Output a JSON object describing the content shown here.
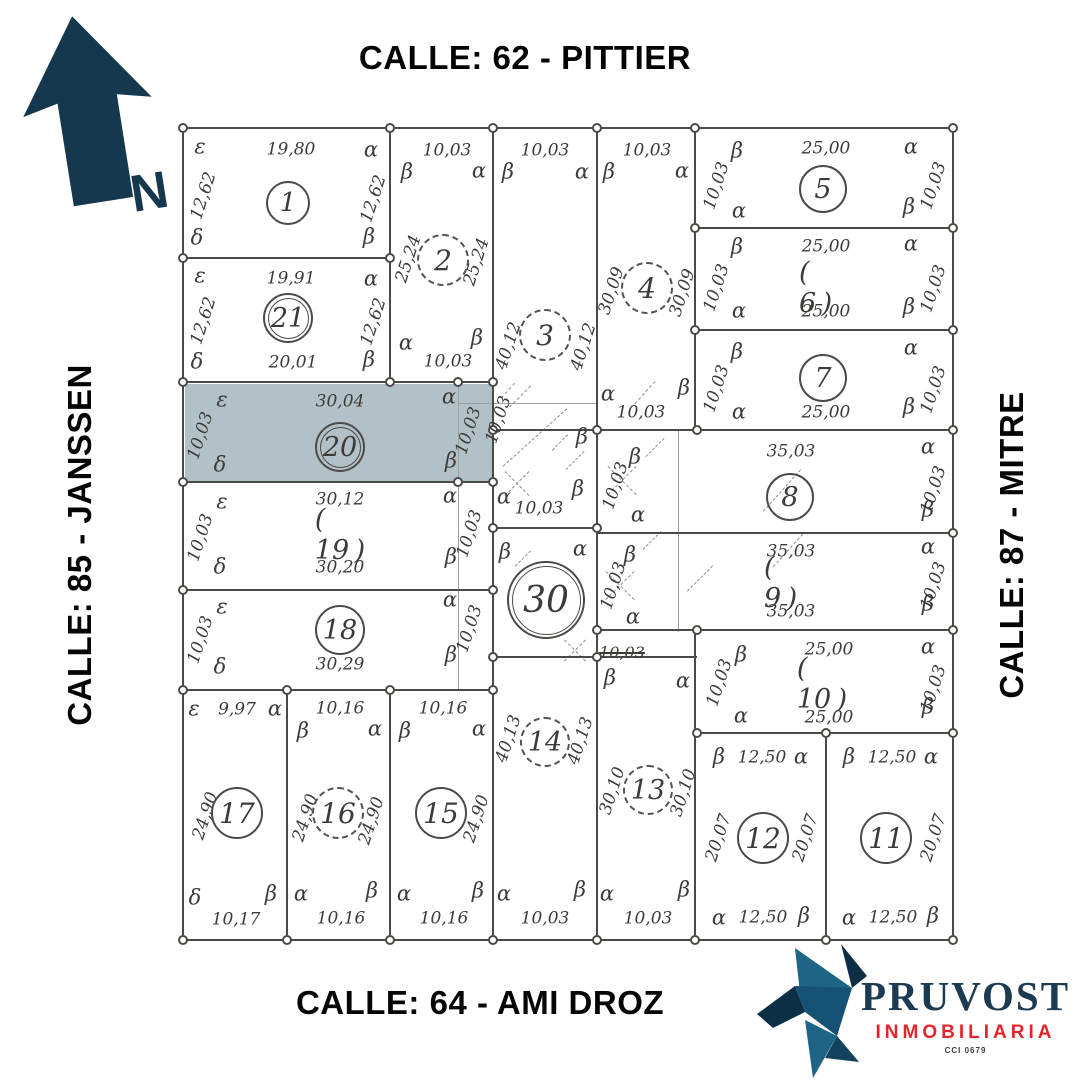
{
  "streets": {
    "top": "CALLE: 62 - PITTIER",
    "bottom": "CALLE: 64 - AMI DROZ",
    "left": "CALLE: 85 - JANSSEN",
    "right": "CALLE: 87 - MITRE"
  },
  "north": {
    "label": "N"
  },
  "logo": {
    "name": "PRUVOST",
    "subtitle": "INMOBILIARIA",
    "registry": "CCI 0679"
  },
  "colors": {
    "line": "#4c4a47",
    "highlight": "#b2c1c7",
    "navy": "#15384f",
    "red": "#e4252b",
    "bird_dark": "#0d2f45",
    "bird_mid": "#155173",
    "bird_light": "#1d6485"
  },
  "highlighted_lot": "20",
  "plan": {
    "highlight": {
      "x": 185,
      "y": 384,
      "w": 307,
      "h": 97
    },
    "lines": [
      [
        "h",
        183,
        128,
        772
      ],
      [
        "h",
        183,
        258,
        209
      ],
      [
        "h",
        183,
        382,
        312
      ],
      [
        "h",
        183,
        482,
        312
      ],
      [
        "h",
        183,
        590,
        312
      ],
      [
        "h",
        183,
        690,
        312
      ],
      [
        "h",
        183,
        940,
        772
      ],
      [
        "h",
        695,
        228,
        260
      ],
      [
        "h",
        695,
        330,
        260
      ],
      [
        "h",
        493,
        430,
        462
      ],
      [
        "h",
        597,
        533,
        358
      ],
      [
        "h",
        597,
        630,
        358
      ],
      [
        "h",
        695,
        733,
        260
      ],
      [
        "h",
        493,
        528,
        106
      ],
      [
        "h",
        493,
        657,
        204,
        1.6
      ],
      [
        "v",
        183,
        128,
        814
      ],
      [
        "v",
        390,
        128,
        256
      ],
      [
        "v",
        493,
        128,
        814
      ],
      [
        "v",
        597,
        128,
        814
      ],
      [
        "v",
        695,
        128,
        304
      ],
      [
        "v",
        695,
        630,
        312
      ],
      [
        "v",
        287,
        690,
        252
      ],
      [
        "v",
        390,
        690,
        252
      ],
      [
        "v",
        826,
        733,
        209
      ],
      [
        "v",
        953,
        128,
        814
      ]
    ],
    "thin_lines": [
      [
        "v",
        458,
        385,
        305
      ],
      [
        "v",
        678,
        430,
        202
      ],
      [
        "h",
        458,
        403,
        140
      ]
    ],
    "dashes": [
      [
        520,
        396,
        30,
        -45
      ],
      [
        508,
        390,
        20,
        -48
      ],
      [
        535,
        437,
        86,
        -42
      ],
      [
        560,
        442,
        22,
        -45
      ],
      [
        517,
        483,
        34,
        -45
      ],
      [
        517,
        483,
        34,
        45
      ],
      [
        575,
        460,
        26,
        -45
      ],
      [
        622,
        480,
        40,
        -45
      ],
      [
        622,
        480,
        40,
        45
      ],
      [
        620,
        585,
        40,
        -45
      ],
      [
        620,
        585,
        40,
        45
      ],
      [
        575,
        650,
        30,
        -45
      ],
      [
        575,
        650,
        30,
        45
      ],
      [
        655,
        447,
        26,
        -45
      ],
      [
        652,
        540,
        26,
        -45
      ],
      [
        645,
        392,
        30,
        -48
      ],
      [
        782,
        490,
        56,
        -48
      ],
      [
        788,
        550,
        44,
        -48
      ],
      [
        700,
        578,
        36,
        -45
      ],
      [
        523,
        558,
        22,
        -45
      ]
    ],
    "nodes": [
      [
        183,
        128
      ],
      [
        390,
        128
      ],
      [
        493,
        128
      ],
      [
        597,
        128
      ],
      [
        695,
        128
      ],
      [
        953,
        128
      ],
      [
        695,
        228
      ],
      [
        953,
        228
      ],
      [
        183,
        258
      ],
      [
        390,
        258
      ],
      [
        695,
        330
      ],
      [
        953,
        330
      ],
      [
        183,
        382
      ],
      [
        390,
        382
      ],
      [
        458,
        382
      ],
      [
        493,
        382
      ],
      [
        493,
        430
      ],
      [
        597,
        430
      ],
      [
        697,
        430
      ],
      [
        953,
        430
      ],
      [
        183,
        482
      ],
      [
        458,
        482
      ],
      [
        493,
        482
      ],
      [
        493,
        528
      ],
      [
        597,
        528
      ],
      [
        953,
        533
      ],
      [
        183,
        590
      ],
      [
        493,
        590
      ],
      [
        597,
        630
      ],
      [
        697,
        630
      ],
      [
        953,
        630
      ],
      [
        493,
        657
      ],
      [
        597,
        657
      ],
      [
        183,
        690
      ],
      [
        287,
        690
      ],
      [
        390,
        690
      ],
      [
        493,
        690
      ],
      [
        697,
        733
      ],
      [
        826,
        733
      ],
      [
        953,
        733
      ],
      [
        183,
        940
      ],
      [
        287,
        940
      ],
      [
        390,
        940
      ],
      [
        493,
        940
      ],
      [
        597,
        940
      ],
      [
        695,
        940
      ],
      [
        826,
        940
      ],
      [
        953,
        940
      ]
    ],
    "labels": [
      [
        "ε",
        200,
        147
      ],
      [
        "19,80",
        291,
        150
      ],
      [
        "α",
        371,
        150
      ],
      [
        "12,62",
        204,
        196,
        -72
      ],
      [
        "12,62",
        374,
        199,
        -72
      ],
      [
        "δ",
        197,
        238
      ],
      [
        "β",
        369,
        237
      ],
      [
        "ε",
        200,
        276
      ],
      [
        "19,91",
        291,
        279
      ],
      [
        "α",
        371,
        279
      ],
      [
        "12,62",
        204,
        321,
        -72
      ],
      [
        "12,62",
        374,
        322,
        -72
      ],
      [
        "δ",
        197,
        362
      ],
      [
        "20,01",
        293,
        363
      ],
      [
        "β",
        369,
        360
      ],
      [
        "10,03",
        447,
        151
      ],
      [
        "β",
        407,
        172
      ],
      [
        "α",
        479,
        171
      ],
      [
        "25,24",
        409,
        259,
        -72
      ],
      [
        "25,24",
        477,
        262,
        -72
      ],
      [
        "α",
        406,
        343
      ],
      [
        "β",
        477,
        338
      ],
      [
        "10,03",
        448,
        362
      ],
      [
        "10,03",
        545,
        151
      ],
      [
        "β",
        508,
        172
      ],
      [
        "α",
        582,
        172
      ],
      [
        "40,12",
        509,
        346,
        -72
      ],
      [
        "40,12",
        584,
        347,
        -72
      ],
      [
        "α",
        504,
        497
      ],
      [
        "10,03",
        539,
        509
      ],
      [
        "β",
        578,
        489
      ],
      [
        "10,03",
        647,
        151
      ],
      [
        "β",
        609,
        172
      ],
      [
        "α",
        682,
        171
      ],
      [
        "30,09",
        612,
        291,
        -72
      ],
      [
        "30,09",
        683,
        293,
        -72
      ],
      [
        "α",
        608,
        394
      ],
      [
        "10,03",
        641,
        413
      ],
      [
        "β",
        684,
        388
      ],
      [
        "β",
        737,
        151
      ],
      [
        "25,00",
        826,
        149
      ],
      [
        "α",
        911,
        147
      ],
      [
        "10,03",
        717,
        186,
        -72
      ],
      [
        "10,03",
        934,
        186,
        -72
      ],
      [
        "α",
        739,
        211
      ],
      [
        "β",
        909,
        207
      ],
      [
        "β",
        737,
        247
      ],
      [
        "25,00",
        826,
        247
      ],
      [
        "α",
        911,
        244
      ],
      [
        "10,03",
        717,
        288,
        -72
      ],
      [
        "10,03",
        934,
        289,
        -72
      ],
      [
        "α",
        739,
        311
      ],
      [
        "25,00",
        826,
        312
      ],
      [
        "β",
        909,
        307
      ],
      [
        "β",
        737,
        352
      ],
      [
        "α",
        911,
        348
      ],
      [
        "10,03",
        717,
        389,
        -72
      ],
      [
        "10,03",
        934,
        390,
        -72
      ],
      [
        "α",
        739,
        412
      ],
      [
        "25,00",
        826,
        413
      ],
      [
        "β",
        909,
        407
      ],
      [
        "35,03",
        791,
        452
      ],
      [
        "α",
        928,
        447
      ],
      [
        "10,03",
        934,
        490,
        -72
      ],
      [
        "β",
        928,
        510
      ],
      [
        "β",
        635,
        457
      ],
      [
        "10,03",
        616,
        486,
        -72
      ],
      [
        "α",
        638,
        515
      ],
      [
        "35,03",
        791,
        552
      ],
      [
        "α",
        928,
        547
      ],
      [
        "10,03",
        934,
        586,
        -72
      ],
      [
        "35,03",
        791,
        612
      ],
      [
        "β",
        928,
        604
      ],
      [
        "β",
        630,
        555
      ],
      [
        "10,03",
        614,
        586,
        -72
      ],
      [
        "α",
        633,
        617
      ],
      [
        "β",
        741,
        655
      ],
      [
        "25,00",
        829,
        650
      ],
      [
        "α",
        928,
        647
      ],
      [
        "10,03",
        720,
        683,
        -72
      ],
      [
        "10,03",
        934,
        689,
        -72
      ],
      [
        "α",
        741,
        716
      ],
      [
        "25,00",
        829,
        718
      ],
      [
        "β",
        928,
        707
      ],
      [
        "β",
        719,
        757
      ],
      [
        "12,50",
        762,
        758
      ],
      [
        "α",
        801,
        757
      ],
      [
        "20,07",
        719,
        838,
        -72
      ],
      [
        "20,07",
        806,
        838,
        -72
      ],
      [
        "α",
        719,
        918
      ],
      [
        "12,50",
        763,
        918
      ],
      [
        "β",
        804,
        916
      ],
      [
        "β",
        849,
        757
      ],
      [
        "12,50",
        892,
        758
      ],
      [
        "α",
        931,
        757
      ],
      [
        "20,07",
        934,
        838,
        -72
      ],
      [
        "α",
        849,
        918
      ],
      [
        "12,50",
        893,
        918
      ],
      [
        "β",
        933,
        916
      ],
      [
        "ε",
        222,
        400
      ],
      [
        "30,04",
        340,
        402
      ],
      [
        "α",
        449,
        397
      ],
      [
        "10,03",
        201,
        436,
        -72
      ],
      [
        "δ",
        220,
        465
      ],
      [
        "β",
        451,
        461
      ],
      [
        "10,03",
        469,
        431,
        -72
      ],
      [
        "10,03",
        499,
        420,
        -72
      ],
      [
        "ε",
        222,
        502
      ],
      [
        "30,12",
        340,
        500
      ],
      [
        "α",
        450,
        496
      ],
      [
        "10,03",
        201,
        538,
        -72
      ],
      [
        "δ",
        220,
        567
      ],
      [
        "30,20",
        340,
        568
      ],
      [
        "β",
        451,
        557
      ],
      [
        "10,03",
        470,
        534,
        -72
      ],
      [
        "ε",
        222,
        607
      ],
      [
        "α",
        450,
        600
      ],
      [
        "10,03",
        201,
        640,
        -72
      ],
      [
        "δ",
        220,
        667
      ],
      [
        "30,29",
        340,
        665
      ],
      [
        "β",
        451,
        655
      ],
      [
        "10,03",
        470,
        629,
        -72
      ],
      [
        "ε",
        194,
        709
      ],
      [
        "9,97",
        237,
        710
      ],
      [
        "α",
        275,
        709
      ],
      [
        "24,90",
        206,
        816,
        -72
      ],
      [
        "δ",
        195,
        898
      ],
      [
        "10,17",
        236,
        920
      ],
      [
        "β",
        271,
        894
      ],
      [
        "10,16",
        340,
        709
      ],
      [
        "β",
        303,
        731
      ],
      [
        "α",
        375,
        729
      ],
      [
        "24,90",
        306,
        818,
        -72
      ],
      [
        "24,90",
        372,
        821,
        -72
      ],
      [
        "α",
        301,
        894
      ],
      [
        "10,16",
        341,
        919
      ],
      [
        "β",
        372,
        891
      ],
      [
        "10,16",
        443,
        709
      ],
      [
        "β",
        405,
        731
      ],
      [
        "α",
        479,
        729
      ],
      [
        "24,90",
        477,
        819,
        -72
      ],
      [
        "α",
        404,
        894
      ],
      [
        "10,16",
        444,
        919
      ],
      [
        "β",
        478,
        891
      ],
      [
        "40,13",
        509,
        739,
        -72
      ],
      [
        "40,13",
        581,
        741,
        -72
      ],
      [
        "α",
        504,
        894
      ],
      [
        "10,03",
        545,
        919
      ],
      [
        "β",
        580,
        890
      ],
      [
        "β",
        610,
        678
      ],
      [
        "α",
        683,
        681
      ],
      [
        "30,10",
        613,
        791,
        -72
      ],
      [
        "30,10",
        684,
        793,
        -72
      ],
      [
        "α",
        607,
        894
      ],
      [
        "10,03",
        648,
        919
      ],
      [
        "β",
        684,
        890
      ],
      [
        "β",
        582,
        437
      ],
      [
        "β",
        505,
        552
      ],
      [
        "α",
        580,
        549
      ],
      [
        "10,03",
        622,
        653,
        0,
        16,
        "strike"
      ]
    ],
    "lots": [
      [
        1,
        288,
        203,
        "c",
        22,
        26
      ],
      [
        21,
        288,
        318,
        "cc",
        25,
        27
      ],
      [
        2,
        443,
        260,
        "d",
        26,
        28
      ],
      [
        3,
        545,
        335,
        "d",
        26,
        28
      ],
      [
        4,
        647,
        288,
        "d",
        26,
        28
      ],
      [
        5,
        823,
        189,
        "c",
        24,
        27
      ],
      [
        6,
        823,
        288,
        "p",
        24,
        27
      ],
      [
        7,
        823,
        378,
        "c",
        24,
        27
      ],
      [
        8,
        790,
        497,
        "c",
        24,
        27
      ],
      [
        9,
        788,
        583,
        "p",
        24,
        27
      ],
      [
        10,
        822,
        684,
        "p",
        24,
        27
      ],
      [
        11,
        886,
        838,
        "c",
        26,
        28
      ],
      [
        12,
        763,
        838,
        "c",
        26,
        28
      ],
      [
        13,
        648,
        790,
        "d",
        25,
        27
      ],
      [
        14,
        545,
        742,
        "d",
        25,
        27
      ],
      [
        15,
        441,
        813,
        "c",
        26,
        28
      ],
      [
        16,
        338,
        813,
        "d",
        26,
        28
      ],
      [
        17,
        237,
        813,
        "c",
        26,
        28
      ],
      [
        18,
        340,
        630,
        "c",
        25,
        27
      ],
      [
        19,
        340,
        535,
        "p",
        25,
        27
      ],
      [
        20,
        340,
        447,
        "cc",
        25,
        27
      ],
      [
        30,
        546,
        600,
        "cc",
        39,
        36
      ]
    ]
  }
}
